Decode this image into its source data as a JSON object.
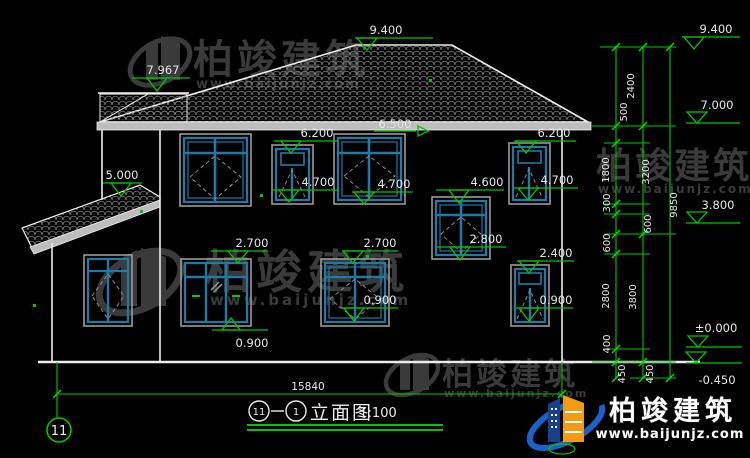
{
  "colors": {
    "background": "#000000",
    "line_white": "#ededed",
    "cad_green": "#00c800",
    "window_teal": "#1f7aa6",
    "frame_gray": "#9a9a9a",
    "watermark_gray": "#3a3a3a",
    "logo_blue": "#1763c9",
    "logo_navy": "#17408f",
    "logo_orange": "#f39c12"
  },
  "watermark": {
    "name": "柏竣建筑",
    "url": "www.baijunjz.com"
  },
  "logo": {
    "name": "柏竣建筑",
    "url": "www.baijunjz.com"
  },
  "levels": {
    "main_ridge": "9.400",
    "wing_ridge": "7.967",
    "porch": "5.000",
    "eave_left": "6.500",
    "eave_a": "6.200",
    "eave_b": "6.200",
    "win2f_a": "4.700",
    "win2f_b": "4.700",
    "win2f_c": "4.700",
    "stair_top": "4.600",
    "win1f_a": "2.700",
    "win1f_b": "2.700",
    "stair_sill": "2.800",
    "win1f_c": "2.400",
    "sill_a": "0.900",
    "sill_b": "0.900",
    "sill_c": "0.900",
    "right_ridge": "9.400",
    "right_eave": "7.000",
    "right_floor2": "3.800",
    "right_ground": "±0.000",
    "right_base": "-0.450"
  },
  "dimensions": {
    "inner": [
      "2400",
      "500",
      "1800",
      "300",
      "600",
      "600",
      "2800",
      "400",
      "450"
    ],
    "middle": [
      "3200",
      "3800",
      "450"
    ],
    "total_height": "9850",
    "total_width": "15840"
  },
  "title": {
    "axis_start": "11",
    "axis_end": "1",
    "name": "立面图",
    "scale": "1:100"
  },
  "grid": {
    "bubble": "11"
  }
}
